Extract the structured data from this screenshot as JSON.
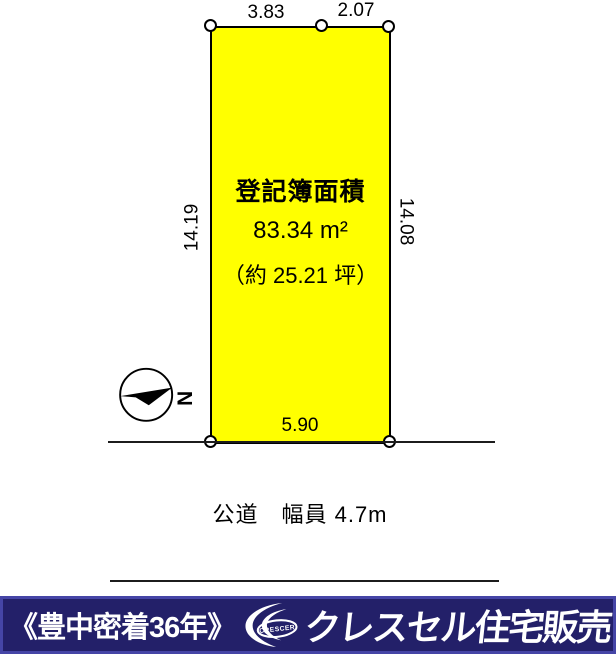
{
  "plot": {
    "fill_color": "#ffff00",
    "area_label": "登記簿面積",
    "area_sqm": "83.34 m²",
    "area_tsubo": "（約 25.21 坪）",
    "dim_top_left": "3.83",
    "dim_top_right": "2.07",
    "dim_left": "14.19",
    "dim_right": "14.08",
    "dim_bottom": "5.90"
  },
  "road": {
    "label": "公道　幅員 4.7m"
  },
  "compass": {
    "north": "N"
  },
  "footer": {
    "slogan": "《豊中密着36年》",
    "logo_text": "CRESCER",
    "company": "クレスセル住宅販売",
    "background_color": "#232069",
    "border_color": "#4545a6",
    "text_color": "#ffffff"
  }
}
